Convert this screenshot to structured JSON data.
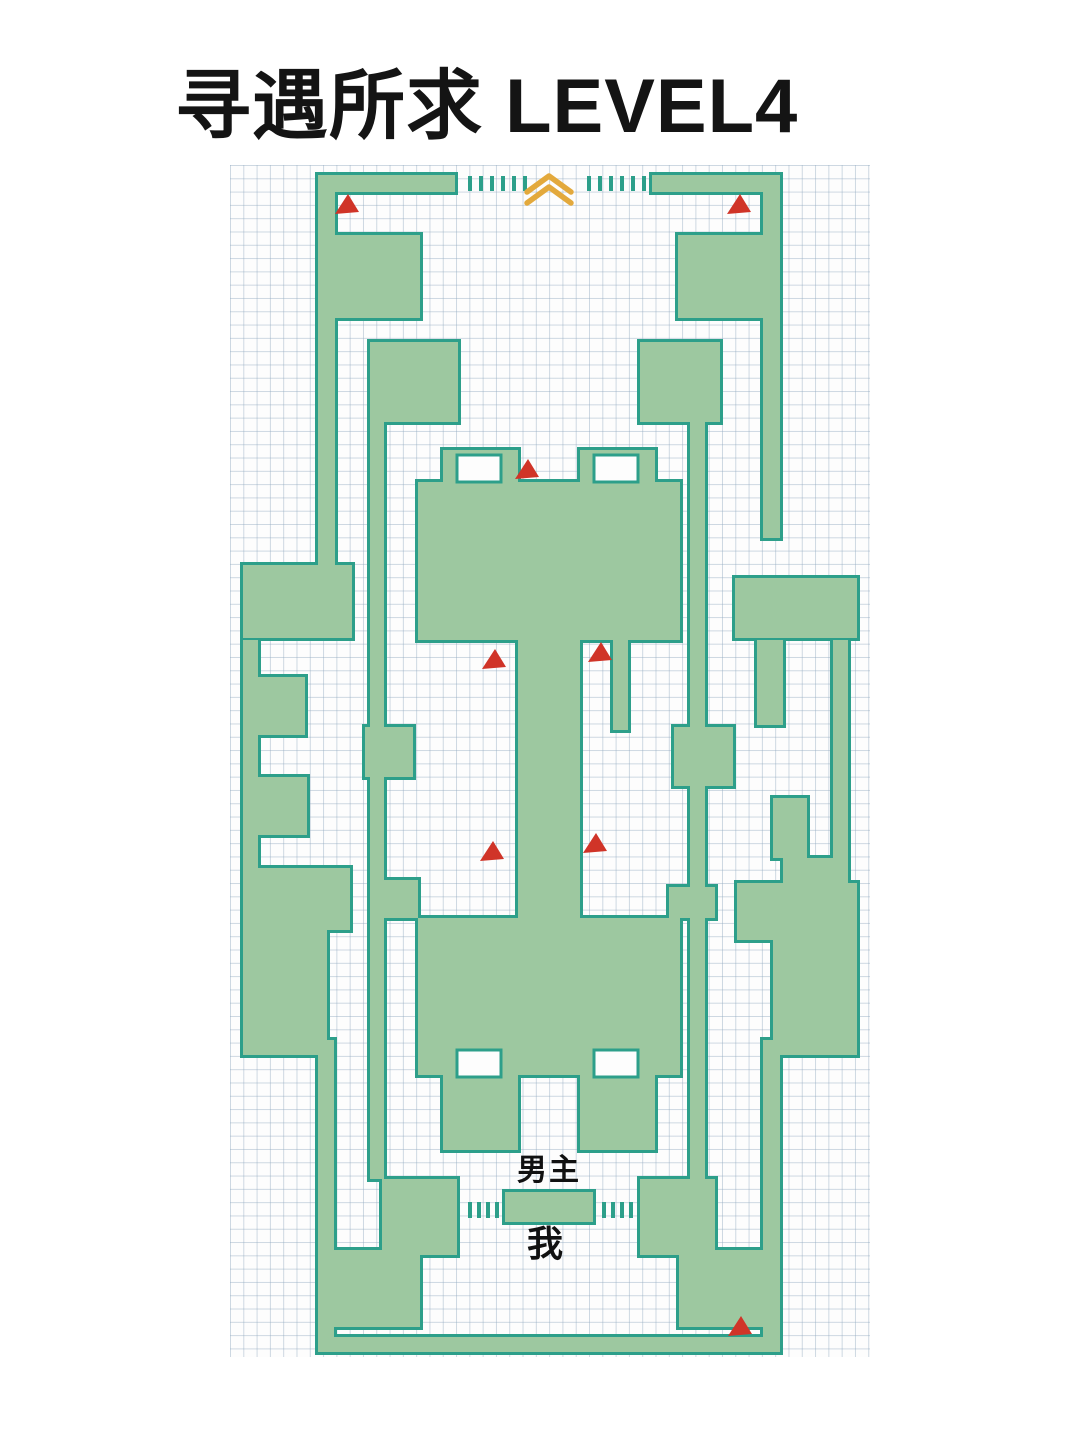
{
  "title": "寻遇所求 LEVEL4",
  "labels": {
    "npc": "男主",
    "player": "我"
  },
  "colors": {
    "wall_fill": "#9dc8a0",
    "wall_border": "#2d9f8a",
    "marker_red": "#d03428",
    "exit_gold": "#e3a93c",
    "map_bg": "#fdfdfd",
    "grid_line": "rgba(146,170,192,0.45)",
    "title_color": "#141414"
  },
  "maze": {
    "origin": {
      "left": 230,
      "top": 165
    },
    "size": {
      "width": 640,
      "height": 1192
    },
    "grid_pitch": 13.3,
    "walls": [
      [
        88,
        10,
        137,
        17
      ],
      [
        422,
        10,
        128,
        17
      ],
      [
        88,
        10,
        17,
        400
      ],
      [
        533,
        10,
        17,
        363
      ],
      [
        88,
        70,
        102,
        83
      ],
      [
        448,
        70,
        102,
        83
      ],
      [
        140,
        177,
        88,
        80
      ],
      [
        410,
        177,
        80,
        80
      ],
      [
        140,
        177,
        14,
        837
      ],
      [
        460,
        177,
        15,
        837
      ],
      [
        135,
        562,
        48,
        50
      ],
      [
        444,
        562,
        59,
        59
      ],
      [
        154,
        715,
        34,
        38
      ],
      [
        439,
        722,
        46,
        31
      ],
      [
        213,
        285,
        75,
        32
      ],
      [
        350,
        285,
        75,
        32
      ],
      [
        188,
        317,
        262,
        158
      ],
      [
        288,
        475,
        62,
        278
      ],
      [
        383,
        475,
        15,
        90
      ],
      [
        188,
        753,
        262,
        157
      ],
      [
        213,
        910,
        75,
        75
      ],
      [
        350,
        910,
        75,
        75
      ],
      [
        13,
        400,
        109,
        73
      ],
      [
        13,
        475,
        15,
        300
      ],
      [
        28,
        512,
        47,
        58
      ],
      [
        28,
        612,
        49,
        58
      ],
      [
        13,
        703,
        107,
        62
      ],
      [
        13,
        753,
        84,
        137
      ],
      [
        88,
        875,
        16,
        302
      ],
      [
        505,
        413,
        122,
        60
      ],
      [
        603,
        475,
        15,
        300
      ],
      [
        527,
        475,
        26,
        85
      ],
      [
        543,
        633,
        34,
        60
      ],
      [
        553,
        693,
        50,
        25
      ],
      [
        507,
        718,
        120,
        57
      ],
      [
        543,
        753,
        84,
        137
      ],
      [
        533,
        875,
        17,
        302
      ],
      [
        152,
        1014,
        75,
        76
      ],
      [
        410,
        1014,
        75,
        76
      ],
      [
        275,
        1027,
        88,
        30
      ],
      [
        103,
        1085,
        87,
        77
      ],
      [
        449,
        1085,
        88,
        77
      ],
      [
        88,
        1172,
        462,
        15
      ]
    ],
    "notches": [
      [
        227,
        290,
        44,
        27
      ],
      [
        364,
        290,
        44,
        27
      ],
      [
        227,
        885,
        44,
        27
      ],
      [
        364,
        885,
        44,
        27
      ]
    ],
    "gate_ticks": {
      "tick_width": 4,
      "top": {
        "y": 11,
        "h": 15,
        "xs": [
          238,
          249,
          260,
          271,
          282,
          293,
          357,
          368,
          379,
          390,
          401,
          412
        ]
      },
      "bottom": {
        "y": 1037,
        "h": 16,
        "xs": [
          238,
          247,
          256,
          265,
          372,
          381,
          390,
          399
        ]
      }
    },
    "exit_chevron": {
      "polylines": [
        "297,27 319,11 341,27",
        "297,38 319,22 341,38"
      ],
      "stroke_width": 5.5
    },
    "markers": [
      [
        117,
        39
      ],
      [
        509,
        39
      ],
      [
        297,
        304
      ],
      [
        264,
        494
      ],
      [
        370,
        487
      ],
      [
        262,
        686
      ],
      [
        365,
        678
      ],
      [
        510,
        1161
      ]
    ],
    "label_anchors": {
      "npc": {
        "x": 319,
        "y": 1002
      },
      "player": {
        "x": 315,
        "y": 1076
      }
    }
  }
}
